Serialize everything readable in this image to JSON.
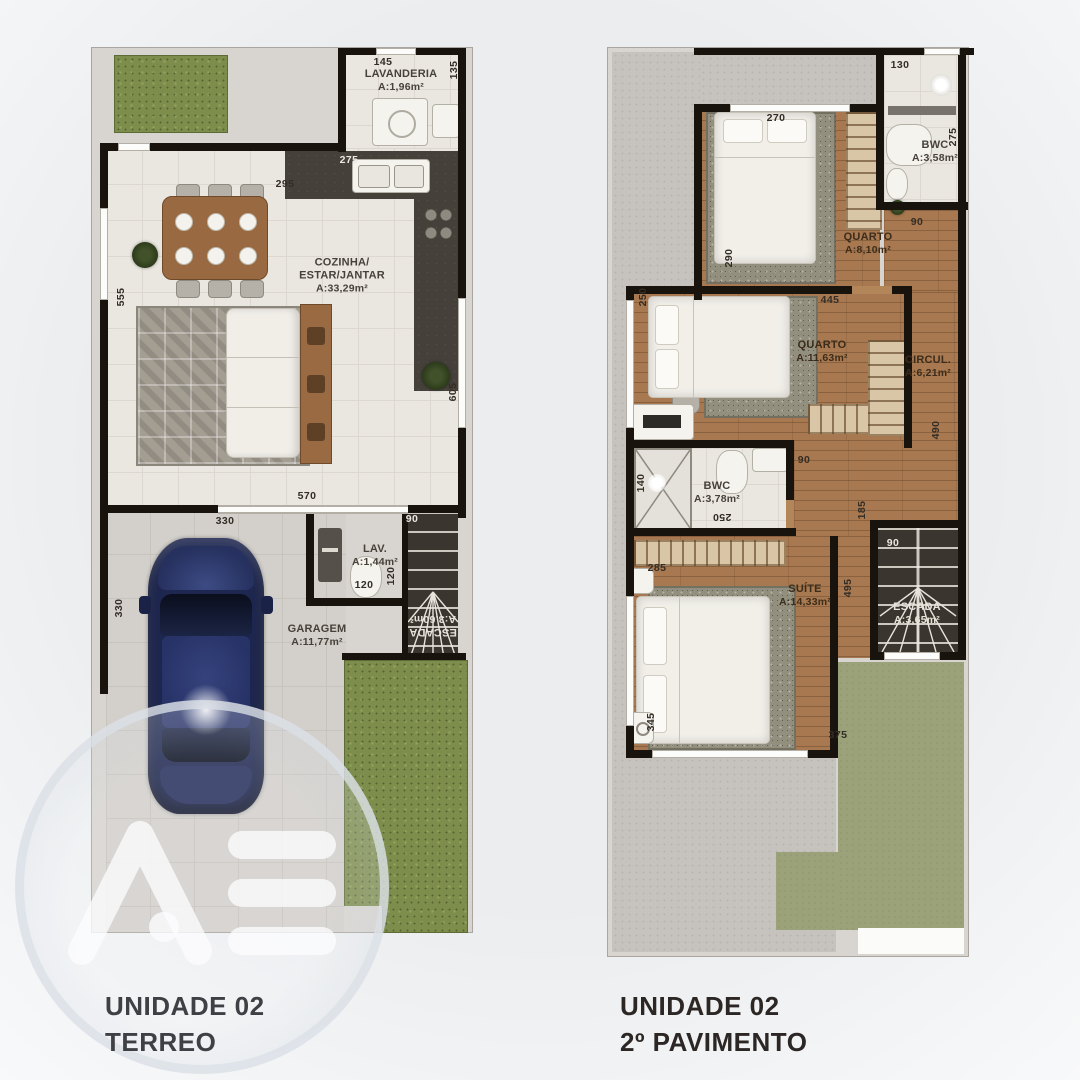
{
  "terreo": {
    "title_line1": "UNIDADE 02",
    "title_line2": "TERREO",
    "rooms": {
      "lavanderia": {
        "name": "LAVANDERIA",
        "area": "A:1,96m²"
      },
      "cozinha": {
        "name_line1": "COZINHA/",
        "name_line2": "ESTAR/JANTAR",
        "area": "A:33,29m²"
      },
      "lav": {
        "name": "LAV.",
        "area": "A:1,44m²"
      },
      "garagem": {
        "name": "GARAGEM",
        "area": "A:11,77m²"
      },
      "escada": {
        "name": "ESCADA",
        "area": "A:3,60m²"
      }
    },
    "dims": {
      "d145": "145",
      "d135": "135",
      "d275": "275",
      "d295": "295",
      "d555": "555",
      "d605": "605",
      "d570": "570",
      "d330a": "330",
      "d90": "90",
      "d120a": "120",
      "d120b": "120",
      "d330b": "330"
    }
  },
  "pavimento": {
    "title_line1": "UNIDADE 02",
    "title_line2": "2º PAVIMENTO",
    "rooms": {
      "bwc1": {
        "name": "BWC",
        "area": "A:3,58m²"
      },
      "quarto1": {
        "name": "QUARTO",
        "area": "A:8,10m²"
      },
      "quarto2": {
        "name": "QUARTO",
        "area": "A:11,63m²"
      },
      "circul": {
        "name": "CIRCUL.",
        "area": "A:6,21m²"
      },
      "bwc2": {
        "name": "BWC",
        "area": "A:3,78m²"
      },
      "suite": {
        "name": "SUÍTE",
        "area": "A:14,33m²"
      },
      "escada": {
        "name": "ESCADA",
        "area": "A:3,65m²"
      }
    },
    "dims": {
      "d130": "130",
      "d275": "275",
      "d270": "270",
      "d90a": "90",
      "d290": "290",
      "d250a": "250",
      "d445": "445",
      "d490": "490",
      "d140": "140",
      "d250b": "250",
      "d90b": "90",
      "d285": "285",
      "d495": "495",
      "d185": "185",
      "d90c": "90",
      "d345": "345",
      "d375": "375"
    }
  },
  "watermark": {
    "letters": "AB"
  },
  "colors": {
    "wall": "#19130d",
    "wood_floor": "#a87950",
    "tile_floor": "#eae7e1",
    "garden_green": "#7d8d4c",
    "terrace_green": "#9ba179",
    "concrete": "#c6c3be",
    "car_blue": "#1e2750",
    "counter_dark": "#45403a"
  }
}
